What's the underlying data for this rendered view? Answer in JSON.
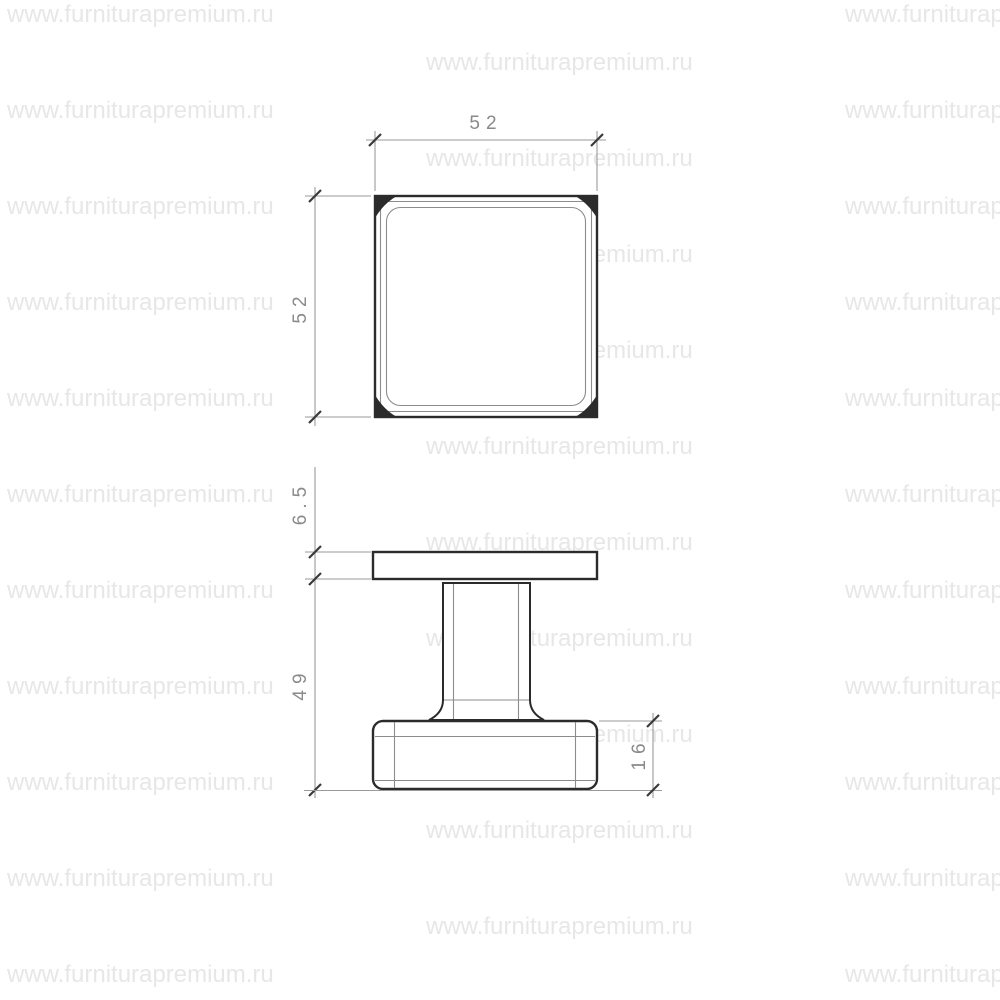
{
  "watermark": {
    "text": "www.furniturapremium.ru",
    "color": "#e7e7e7"
  },
  "drawing": {
    "type": "technical-dimension-drawing",
    "views": [
      "top-view-square-plate",
      "side-view-knob"
    ],
    "dimensions": {
      "top_width": "52",
      "top_height": "52",
      "plate_thickness": "6.5",
      "body_height": "49",
      "base_height": "16"
    }
  },
  "colors": {
    "background": "#ffffff",
    "object_line": "#2b2b2b",
    "thin_line": "#8c8c8c",
    "dim_line": "#9a9a9a",
    "tick": "#3a3a3a",
    "dim_text": "#8a8a8a",
    "watermark": "#e7e7e7"
  }
}
